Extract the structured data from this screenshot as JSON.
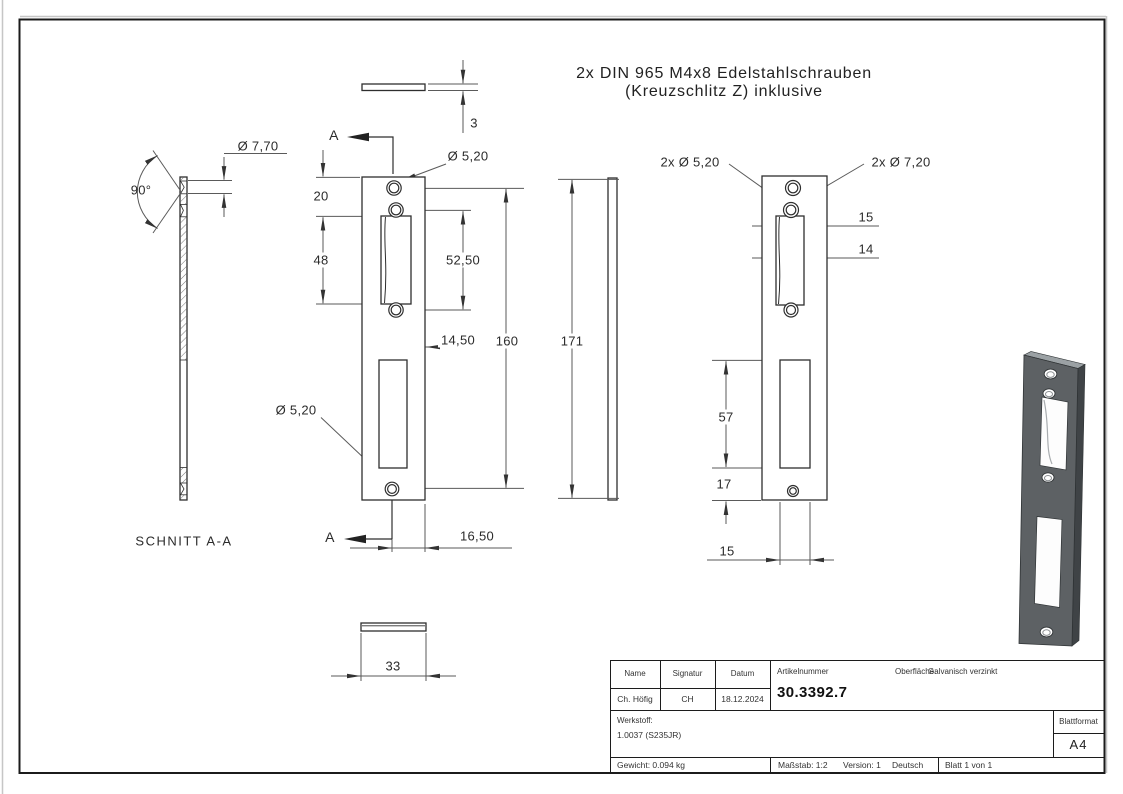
{
  "note": {
    "line1": "2x DIN 965 M4x8 Edelstahlschrauben",
    "line2": "(Kreuzschlitz Z) inklusive"
  },
  "section_view": {
    "title": "SCHNITT A-A",
    "angle": "90°",
    "countersink_dia": "Ø 7,70"
  },
  "front_view": {
    "cut_marker_top": "A",
    "cut_marker_bottom": "A",
    "thickness": "3",
    "top_hole_dia": "Ø 5,20",
    "bottom_hole_dia": "Ø 5,20",
    "dim_20": "20",
    "dim_48": "48",
    "dim_52_50": "52,50",
    "dim_14_50": "14,50",
    "dim_160": "160",
    "dim_16_50": "16,50",
    "dim_33": "33"
  },
  "side_view": {
    "dim_171": "171"
  },
  "right_view": {
    "holes_small": "2x Ø 5,20",
    "holes_countersink": "2x Ø 7,20",
    "dim_15_top": "15",
    "dim_14": "14",
    "dim_57": "57",
    "dim_17": "17",
    "dim_15_bottom": "15"
  },
  "title_block": {
    "col_name": "Name",
    "col_signatur": "Signatur",
    "col_datum": "Datum",
    "name": "Ch. Höfig",
    "signatur": "CH",
    "datum": "18.12.2024",
    "artikelnummer_label": "Artikelnummer",
    "artikelnummer": "30.3392.7",
    "oberflaeche_label": "Oberfläche:",
    "oberflaeche": "Galvanisch verzinkt",
    "werkstoff_label": "Werkstoff:",
    "werkstoff": "1.0037 (S235JR)",
    "blattformat_label": "Blattformat",
    "blattformat": "A4",
    "gewicht": "Gewicht: 0.094 kg",
    "massstab": "Maßstab: 1:2",
    "version": "Version: 1",
    "sprache": "Deutsch",
    "blatt": "Blatt 1 von 1"
  }
}
